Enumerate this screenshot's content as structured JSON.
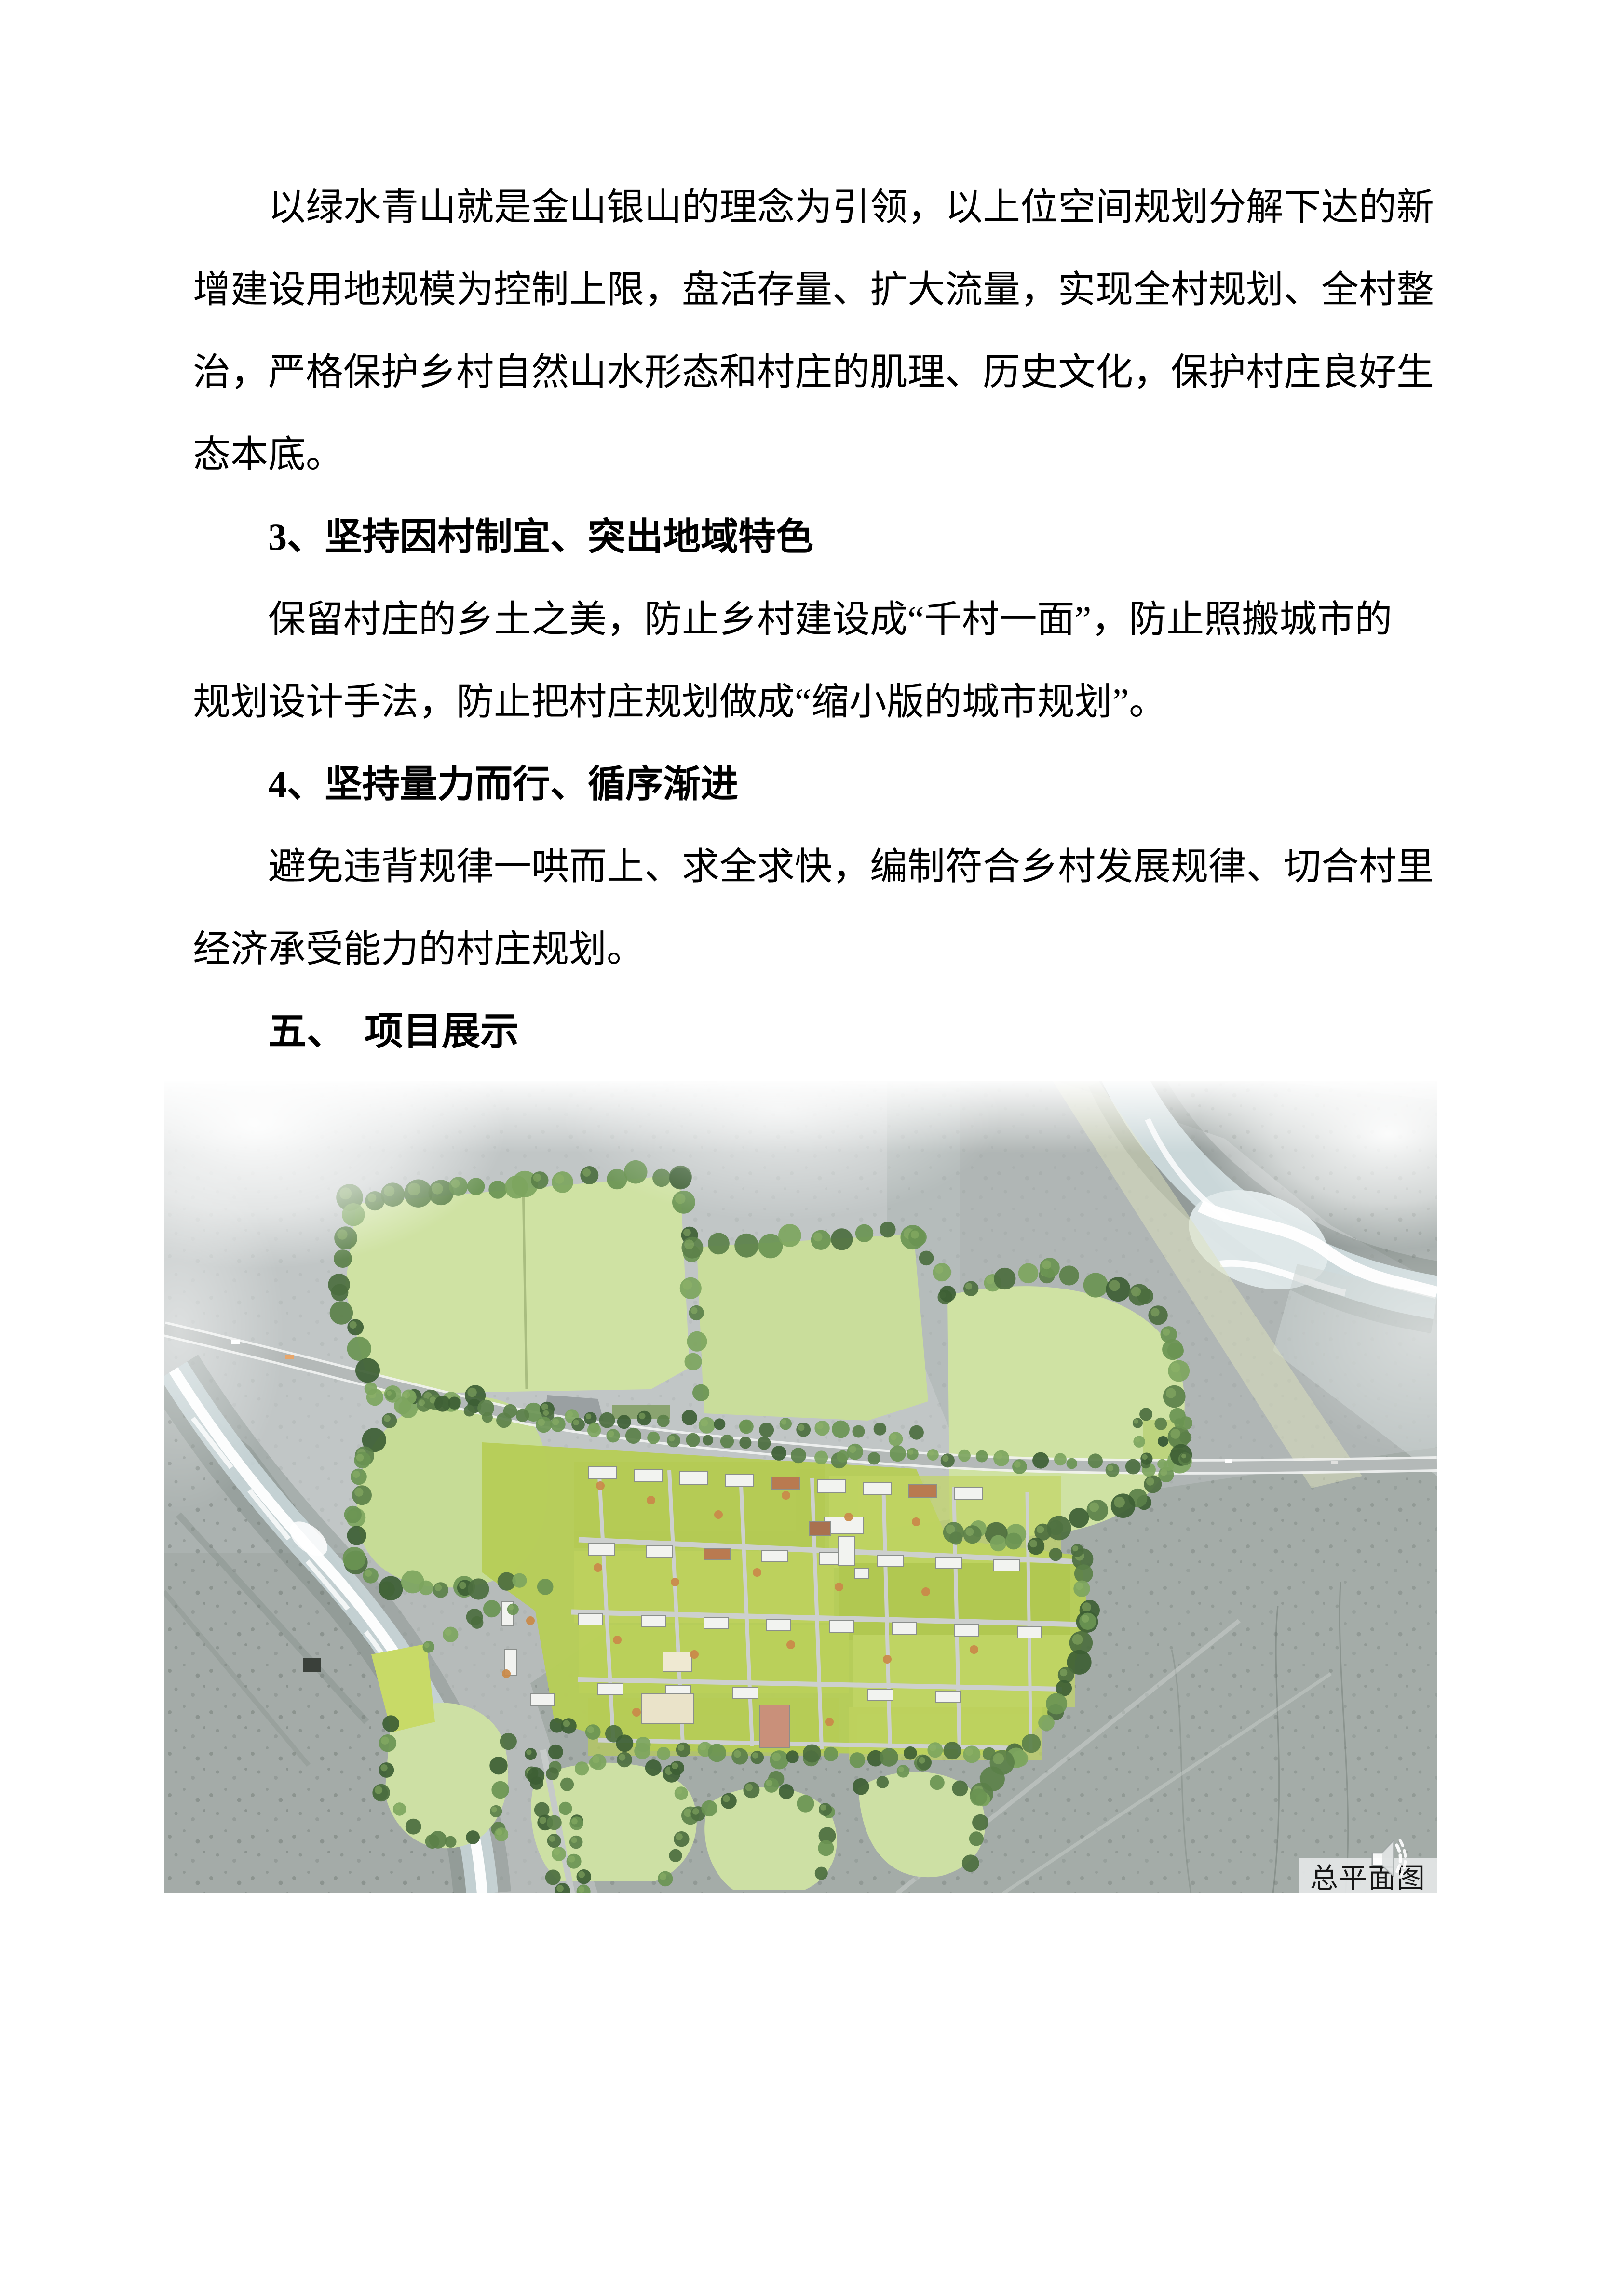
{
  "document": {
    "lines": [
      {
        "style": "body-indent",
        "text": "以绿水青山就是金山银山的理念为引领，以上位空间规划分解下达的新"
      },
      {
        "style": "body",
        "text": "增建设用地规模为控制上限，盘活存量、扩大流量，实现全村规划、全村整"
      },
      {
        "style": "body",
        "text": "治，严格保护乡村自然山水形态和村庄的肌理、历史文化，保护村庄良好生"
      },
      {
        "style": "body",
        "text": "态本底。"
      },
      {
        "style": "heading-bold-indent",
        "text": "3、坚持因村制宜、突出地域特色"
      },
      {
        "style": "body-indent",
        "text": "保留村庄的乡土之美，防止乡村建设成“千村一面”，防止照搬城市的"
      },
      {
        "style": "body",
        "text": "规划设计手法，防止把村庄规划做成“缩小版的城市规划”。"
      },
      {
        "style": "heading-bold-indent",
        "text": "4、坚持量力而行、循序渐进"
      },
      {
        "style": "body-indent",
        "text": "避免违背规律一哄而上、求全求快，编制符合乡村发展规律、切合村里"
      },
      {
        "style": "body",
        "text": "经济承受能力的村庄规划。"
      },
      {
        "style": "heading-hei-indent",
        "text": "五、　项目展示"
      }
    ]
  },
  "figure": {
    "caption": "总平面图",
    "icon": "speaker-icon"
  },
  "colors": {
    "terrain": "#b6bbba",
    "terrain_light": "#c8cdcc",
    "terrain_dark": "#8a948f",
    "field_green": "#cfe2a3",
    "village_green": "#b7cd58",
    "tree_palette": [
      "#3d5e34",
      "#4c6e3f",
      "#5b8049",
      "#6a9453",
      "#7da55e"
    ],
    "tree_highlight": "#8fb468",
    "road_grey": "#b4b9b8",
    "water_wash": "#c9d6d8",
    "water_white": "#ffffff",
    "orange_tree": "#c98a4a",
    "building_white": "#f2f3f0",
    "building_roof": "#b97a50",
    "caption_bg": "#e3e6e6",
    "text_black": "#000000"
  }
}
